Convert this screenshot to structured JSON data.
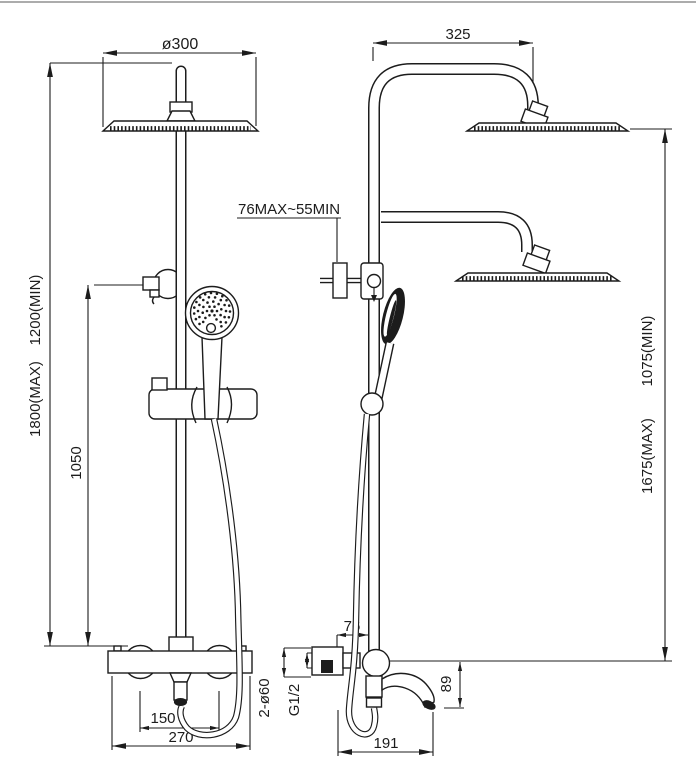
{
  "meta": {
    "type": "technical-dimension-drawing",
    "subject": "shower-column-two-views",
    "ink_color": "#1c1c1c",
    "background_color": "#ffffff",
    "border_color": "#909090"
  },
  "dims": {
    "head_diameter": "ø300",
    "arm_reach": "325",
    "bracket_range": "76MAX~55MIN",
    "overall_min": "1200(MIN)",
    "overall_max": "1800(MAX)",
    "bracket_height": "1050",
    "riser_min": "1075(MIN)",
    "riser_max": "1675(MAX)",
    "wall_offset": "76",
    "spout_drop": "89",
    "inlet_spacing": "150",
    "valve_width": "270",
    "spout_reach": "191",
    "escutcheon": "2-ø60",
    "thread": "G1/2"
  }
}
